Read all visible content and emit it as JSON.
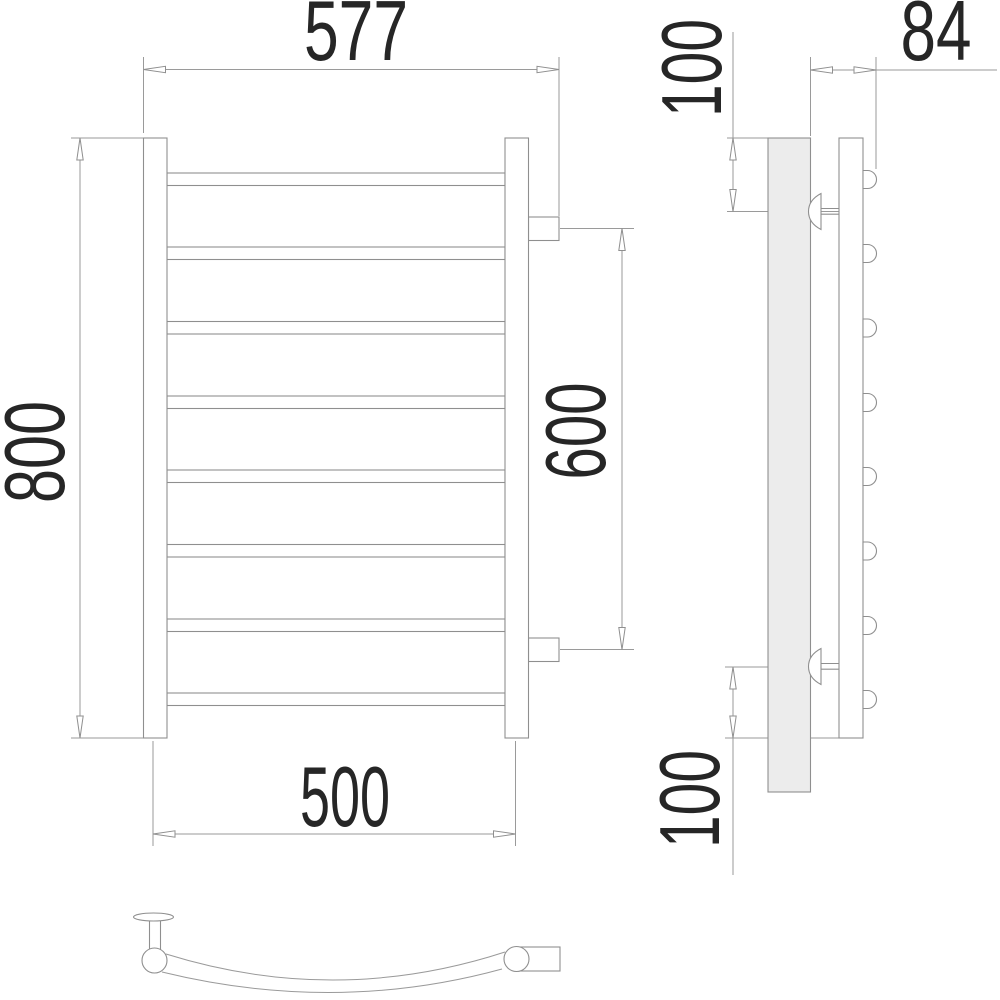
{
  "drawing_type": "technical drawing of a wall-mounted curved ladder towel rail, three orthographic views",
  "units": "mm",
  "labels": {
    "overall_width": "577",
    "overall_height": "800",
    "connection_spacing": "600",
    "bar_width": "500",
    "wall_depth": "84",
    "top_bracket_offset": "100",
    "bottom_bracket_offset": "100"
  },
  "views": {
    "front": {
      "rungs": 8,
      "stiles": 2,
      "connection_stubs": 2
    },
    "side": {
      "wall_plate": true,
      "brackets": 2,
      "rung_ends": 8
    },
    "top": {
      "curved_rail": true,
      "wall_bracket": 1,
      "connection_stub": 1
    }
  },
  "colors": {
    "background": "#ffffff",
    "lines": "#8f8f8f",
    "text": "#262626",
    "wall_plate_fill": "#ececec"
  }
}
